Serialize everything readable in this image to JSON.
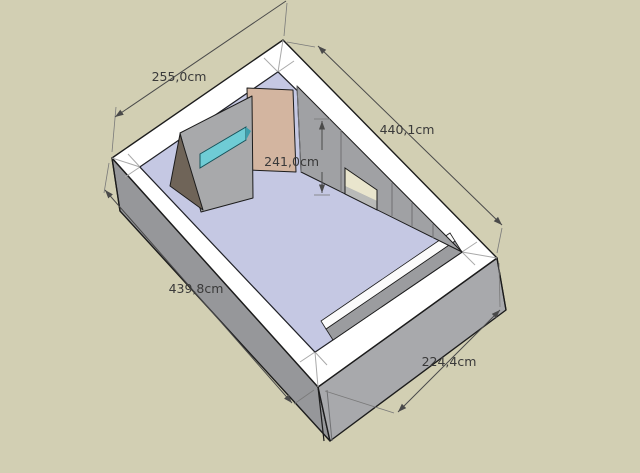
{
  "app": {
    "name": "3d-room-model-viewport",
    "description": "SketchUp-style 3D view of a rectangular room with wall dimension annotations"
  },
  "viewport": {
    "width": 640,
    "height": 473,
    "background_color": "#d2cfb3"
  },
  "palette": {
    "ground": "#d2cfb3",
    "wall_top": "#ffffff",
    "wall_outer_left": "#96979a",
    "wall_outer_right": "#a8a9ac",
    "wall_inner": "#a0a1a4",
    "floor": "#c5c8e3",
    "partition": "#a8a9ab",
    "window_glass": "#6fccd5",
    "door_panel": "#d3b5a0",
    "corner_wedge": "#6f6458",
    "doorway_opening": "#e9e5cd",
    "edge_outline": "#1c1c1c",
    "dimension_color": "#4a4a4a"
  },
  "model": {
    "floor_name": "room floor",
    "objects": [
      "wall-top-ring",
      "outer-wall-faces",
      "interior-right-wall",
      "doorway-opening",
      "interior-partition",
      "partition-window",
      "door-panel",
      "corner-wedge",
      "ledge-strip"
    ]
  },
  "dimensions": [
    {
      "id": "top-left-wall-length",
      "label": "255,0cm"
    },
    {
      "id": "top-right-wall-length",
      "label": "440,1cm"
    },
    {
      "id": "wall-height",
      "label": "241,0cm"
    },
    {
      "id": "bottom-left-wall-length",
      "label": "439,8cm"
    },
    {
      "id": "bottom-right-wall-length",
      "label": "224,4cm"
    }
  ]
}
